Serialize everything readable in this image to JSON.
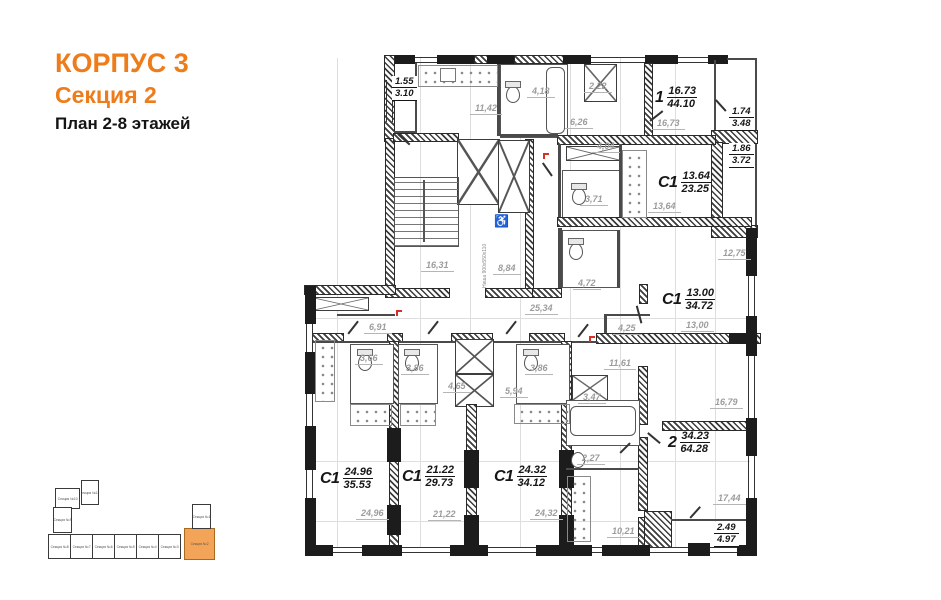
{
  "header": {
    "building": "КОРПУС 3",
    "section": "Секция 2",
    "plan": "План 2-8 этажей"
  },
  "colors": {
    "accent": "#ee7c1a",
    "minimap_highlight": "#f4a458",
    "dim_text": "#9c9c9c",
    "wall": "#1c1c1c"
  },
  "apartments": [
    {
      "type": "1",
      "living": "16.73",
      "total": "44.10"
    },
    {
      "type": "С1",
      "living": "13.64",
      "total": "23.25"
    },
    {
      "type": "С1",
      "living": "13.00",
      "total": "34.72"
    },
    {
      "type": "2",
      "living": "34.23",
      "total": "64.28"
    },
    {
      "type": "С1",
      "living": "24.96",
      "total": "35.53"
    },
    {
      "type": "С1",
      "living": "21.22",
      "total": "29.73"
    },
    {
      "type": "С1",
      "living": "24.32",
      "total": "34.12"
    }
  ],
  "balconies": [
    {
      "a": "1.55",
      "b": "3.10"
    },
    {
      "a": "1.74",
      "b": "3.48"
    },
    {
      "a": "1.86",
      "b": "3.72"
    },
    {
      "a": "2.49",
      "b": "4.97"
    }
  ],
  "dims": [
    {
      "v": "11,42"
    },
    {
      "v": "4,18"
    },
    {
      "v": "2,22"
    },
    {
      "v": "6,26"
    },
    {
      "v": "16,73"
    },
    {
      "v": "4,04"
    },
    {
      "v": "3,71"
    },
    {
      "v": "13,64"
    },
    {
      "v": "12,75"
    },
    {
      "v": "4,72"
    },
    {
      "v": "16,31"
    },
    {
      "v": "8,84"
    },
    {
      "v": "25,34"
    },
    {
      "v": "6,91"
    },
    {
      "v": "4,25"
    },
    {
      "v": "13,00"
    },
    {
      "v": "3,66"
    },
    {
      "v": "3,86"
    },
    {
      "v": "3,86"
    },
    {
      "v": "11,61"
    },
    {
      "v": "4,65"
    },
    {
      "v": "5,94"
    },
    {
      "v": "3,47"
    },
    {
      "v": "16,79"
    },
    {
      "v": "2,27"
    },
    {
      "v": "24,96"
    },
    {
      "v": "21,22"
    },
    {
      "v": "24,32"
    },
    {
      "v": "10,21"
    },
    {
      "v": "17,44"
    }
  ],
  "annotations": {
    "niche": "Ниша 900х550х110",
    "wheelchair": "♿"
  },
  "minimap": {
    "sections": [
      {
        "label": "Секция №11",
        "highlighted": false
      },
      {
        "label": "Секция №10",
        "highlighted": false
      },
      {
        "label": "Секция №9",
        "highlighted": false
      },
      {
        "label": "Секция №8",
        "highlighted": false
      },
      {
        "label": "Секция №7",
        "highlighted": false
      },
      {
        "label": "Секция №6",
        "highlighted": false
      },
      {
        "label": "Секция №5",
        "highlighted": false
      },
      {
        "label": "Секция №4",
        "highlighted": false
      },
      {
        "label": "Секция №3",
        "highlighted": false
      },
      {
        "label": "Секция №2",
        "highlighted": true
      },
      {
        "label": "Секция №1",
        "highlighted": false
      }
    ]
  }
}
